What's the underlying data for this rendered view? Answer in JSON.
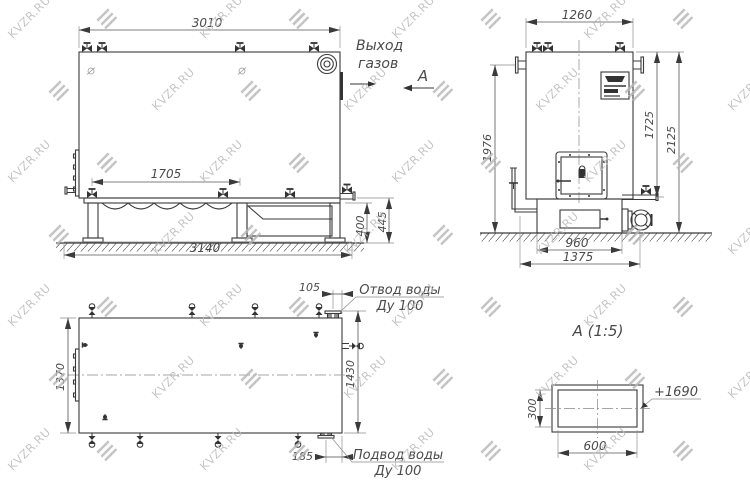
{
  "watermark": {
    "text": "KVZR.RU"
  },
  "labels": {
    "gas_out_1": "Выход",
    "gas_out_2": "газов",
    "section_mark": "А",
    "detail_title": "А  (1:5)",
    "outlet_1": "Отвод воды",
    "outlet_2": "Ду 100",
    "inlet_1": "Подвод воды",
    "inlet_2": "Ду 100"
  },
  "dims": {
    "side_overall_length": "3010",
    "side_span": "1705",
    "side_base_length": "3140",
    "side_base_height": "400",
    "side_base_total": "445",
    "front_overall_width": "1260",
    "front_left_height": "1976",
    "front_body_height": "1725",
    "front_total_height": "2125",
    "front_base_width": "960",
    "front_base_total": "1375",
    "plan_outlet_offset": "105",
    "plan_depth": "1370",
    "plan_span": "1430",
    "plan_inlet_offset": "185",
    "detail_height": "300",
    "detail_width": "600",
    "detail_elevation": "+1690"
  }
}
